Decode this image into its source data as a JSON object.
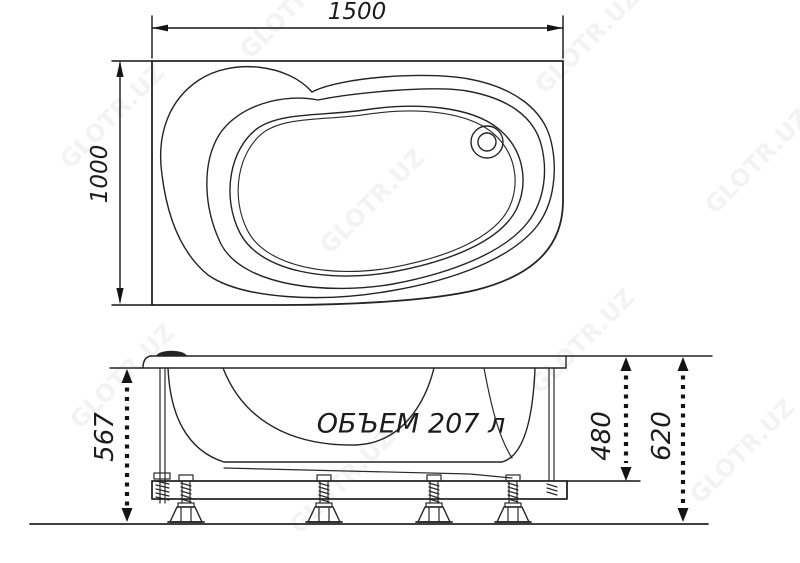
{
  "drawing": {
    "background": "#ffffff",
    "line_color": "#242424",
    "text_color": "#1c1c1c",
    "top_view": {
      "width_mm": "1500",
      "depth_mm": "1000"
    },
    "side_view": {
      "volume_label": "ОБЪЕМ 207 л",
      "height_under_rim_mm": "567",
      "body_height_mm": "480",
      "overall_height_mm": "620",
      "feet_count": 4
    },
    "watermark": {
      "text": "GLOTR.UZ",
      "opacity": 0.042
    }
  }
}
